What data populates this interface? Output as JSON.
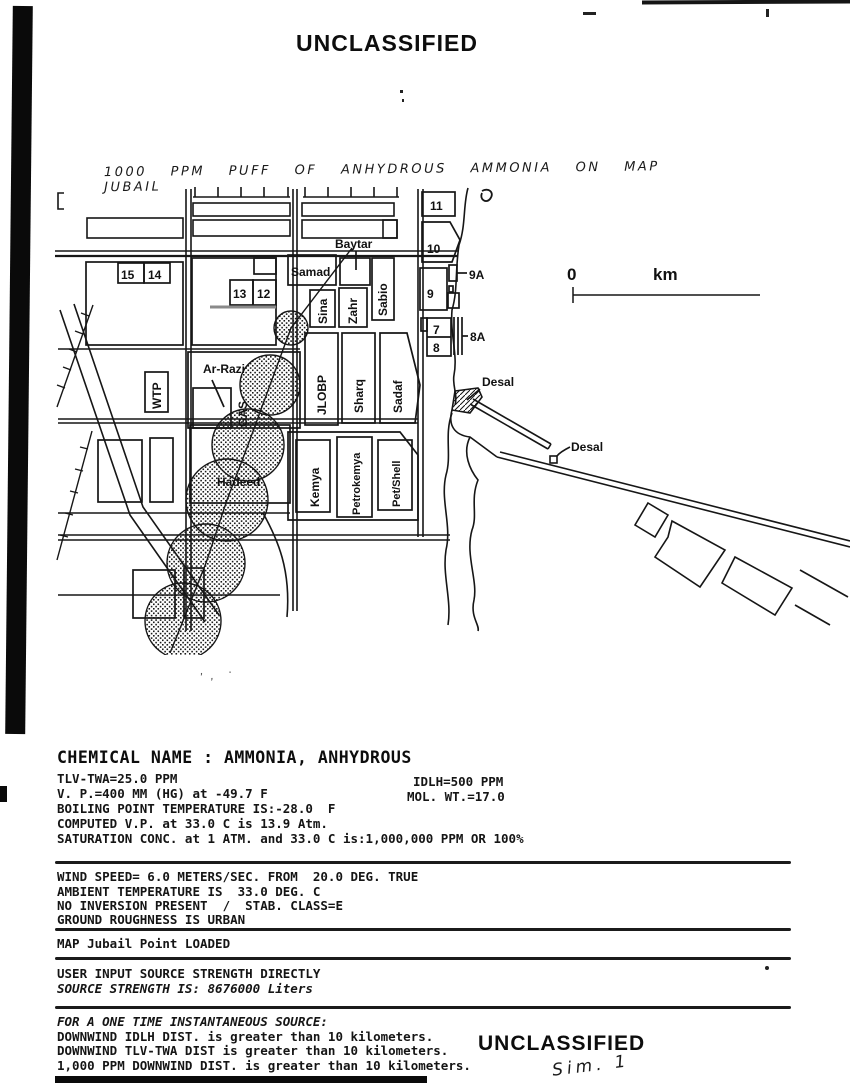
{
  "page": {
    "top_classification": "UNCLASSIFIED",
    "bottom_classification": "UNCLASSIFIED",
    "handwritten_title": "1000 PPM PUFF OF ANHYDROUS AMMONIA ON MAP JUBAIL",
    "handwritten_sim_label": "Sim. 1"
  },
  "map": {
    "scale": {
      "zero": "0",
      "unit": "km"
    },
    "labels": {
      "baytar": "Baytar",
      "samad": "Samad",
      "sina": "Sina",
      "zahr": "Zahr",
      "sabio": "Sabio",
      "jlobp": "JLOBP",
      "sharq": "Sharq",
      "sadaf": "Sadaf",
      "wtp": "WTP",
      "ar_razi": "Ar-Razi",
      "gas": "GAS",
      "hadeed": "Hadeed",
      "kemya": "Kemya",
      "petrokemya": "Petrokemya",
      "pet_shell": "Pet/Shell",
      "desal_north": "Desal",
      "desal_south": "Desal",
      "n15": "15",
      "n14": "14",
      "n13": "13",
      "n12": "12",
      "n11": "11",
      "n10": "10",
      "n9": "9",
      "n9a": "9A",
      "n7": "7",
      "n8": "8",
      "n8a": "8A"
    }
  },
  "report": {
    "chemical_header": "CHEMICAL NAME : AMMONIA, ANHYDROUS",
    "properties_left": [
      "TLV-TWA=25.0 PPM",
      "V. P.=400 MM (HG) at -49.7 F",
      "BOILING POINT TEMPERATURE IS:-28.0  F",
      "COMPUTED V.P. at 33.0 C is 13.9 Atm.",
      "SATURATION CONC. at 1 ATM. and 33.0 C is:1,000,000 PPM OR 100%"
    ],
    "properties_right": [
      "IDLH=500 PPM",
      "MOL. WT.=17.0"
    ],
    "conditions": [
      "WIND SPEED= 6.0 METERS/SEC. FROM  20.0 DEG. TRUE",
      "AMBIENT TEMPERATURE IS  33.0 DEG. C",
      "NO INVERSION PRESENT  /  STAB. CLASS=E",
      "GROUND ROUGHNESS IS URBAN"
    ],
    "map_status": "MAP Jubail Point LOADED",
    "source": [
      "USER INPUT SOURCE STRENGTH DIRECTLY",
      "SOURCE STRENGTH IS: 8676000 Liters"
    ],
    "results_header": "FOR A ONE TIME INSTANTANEOUS SOURCE:",
    "results": [
      "DOWNWIND IDLH DIST. is greater than 10 kilometers.",
      "DOWNWIND TLV-TWA DIST is greater than 10 kilometers.",
      "1,000 PPM DOWNWIND DIST. is greater than 10 kilometers."
    ]
  }
}
